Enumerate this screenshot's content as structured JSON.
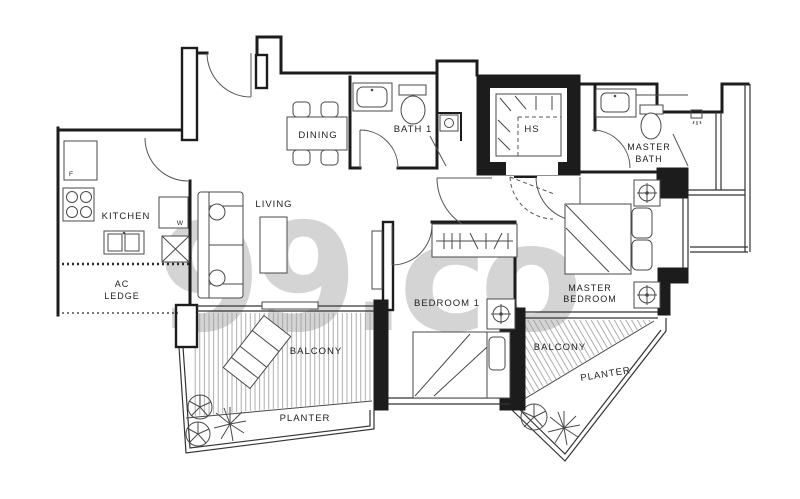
{
  "watermark": "99.co",
  "rooms": {
    "kitchen": {
      "label": "KITCHEN"
    },
    "ac_ledge": {
      "line1": "AC",
      "line2": "LEDGE"
    },
    "dining": {
      "label": "DINING"
    },
    "living": {
      "label": "LIVING"
    },
    "bath1": {
      "label": "BATH 1"
    },
    "hs": {
      "label": "HS"
    },
    "master_bath": {
      "line1": "MASTER",
      "line2": "BATH"
    },
    "bedroom1": {
      "label": "BEDROOM 1"
    },
    "master_bedroom": {
      "line1": "MASTER",
      "line2": "BEDROOM"
    },
    "balcony_left": {
      "label": "BALCONY"
    },
    "planter_left": {
      "label": "PLANTER"
    },
    "balcony_right": {
      "label": "BALCONY"
    },
    "planter_right": {
      "label": "PLANTER"
    }
  },
  "appliances": {
    "fridge": "F",
    "washer": "W"
  },
  "colors": {
    "wall": "#1c1c1c",
    "fixture_line": "#4a4a4a",
    "hatch": "#9a9a9a",
    "watermark": "#d4d4d4",
    "label": "#1f1f1f",
    "background": "#ffffff"
  }
}
